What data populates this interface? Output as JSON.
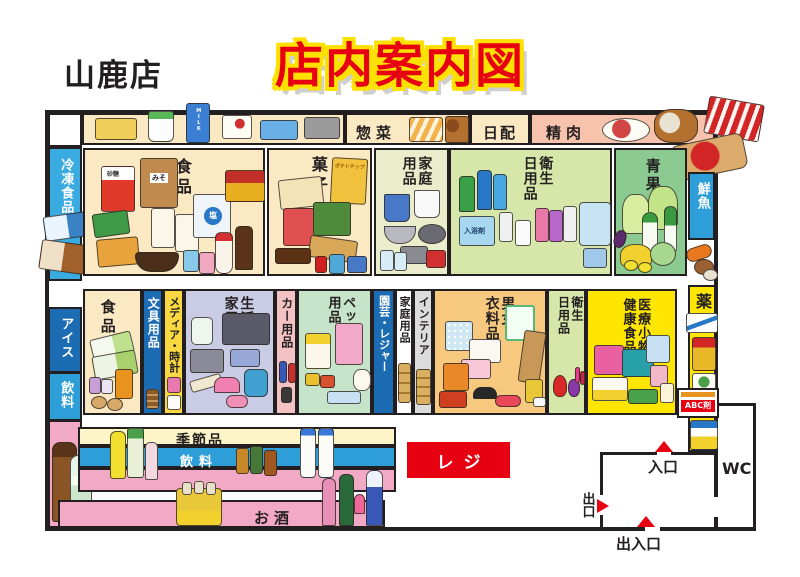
{
  "title": "店内案内図",
  "store_name": "山鹿店",
  "perimeter": {
    "frozen_food": "冷凍食品",
    "ice_cream": "アイス",
    "beverage_left": "飲料",
    "deli": "惣菜",
    "daily_products": "日配",
    "meat": "精肉",
    "fresh_fish": "鮮魚",
    "medicine": "薬"
  },
  "row1": {
    "food": "食品",
    "confectionery": "菓子",
    "household": "家庭\n用品",
    "hygiene_daily": "衛生\n日用品",
    "produce": "青果"
  },
  "row2": {
    "food": "食品",
    "stationery": "文具用品",
    "media_clocks": "メディア・時計",
    "home_appliances": "生活\n家電",
    "car_goods": "カー用品",
    "pet_goods": "ペット\n用品",
    "garden_leisure": "園芸・レジャー",
    "household": "家庭用品",
    "interior": "インテリア",
    "clothing": "男女\n衣料品",
    "hygiene_daily": "衛生\n日用品",
    "medical_health": "医療小物\n健康食品"
  },
  "bottom": {
    "seasonal": "季節品",
    "beverage": "飲料",
    "alcohol": "お酒",
    "register": "レジ"
  },
  "doors": {
    "entrance": "入口",
    "exit": "出口",
    "entrance_exit": "出入口",
    "toilet": "WC"
  },
  "product_labels": {
    "sugar": "砂糖",
    "miso": "みそ",
    "salt": "塩",
    "potato_chips": "ポテトチップ",
    "bath_salts": "入浴剤",
    "milk": "MILK",
    "abc_sign": "ABC剤"
  },
  "colors": {
    "accent_red": "#e60012",
    "title_yellow": "#ffe100",
    "wall": "#231f20",
    "cream": "#fbe9c4",
    "pink_meat": "#f7c3ac",
    "olive": "#eaedcb",
    "light_green": "#d6e7a9",
    "produce_green": "#8bcb92",
    "lavender": "#cacbe5",
    "strip_blue": "#1c6cb4",
    "media_yellow": "#f8d841",
    "car_pink": "#f3c3c3",
    "pet_green": "#c6e4c9",
    "interior_gray": "#dcdcdc",
    "clothing_orange": "#f6c97e",
    "bright_yellow": "#ffe600",
    "frozen_blue": "#3aabe0",
    "sky_blue": "#2e9ed8",
    "alcohol_pink": "#f2a9c5",
    "register_red": "#e60012"
  }
}
